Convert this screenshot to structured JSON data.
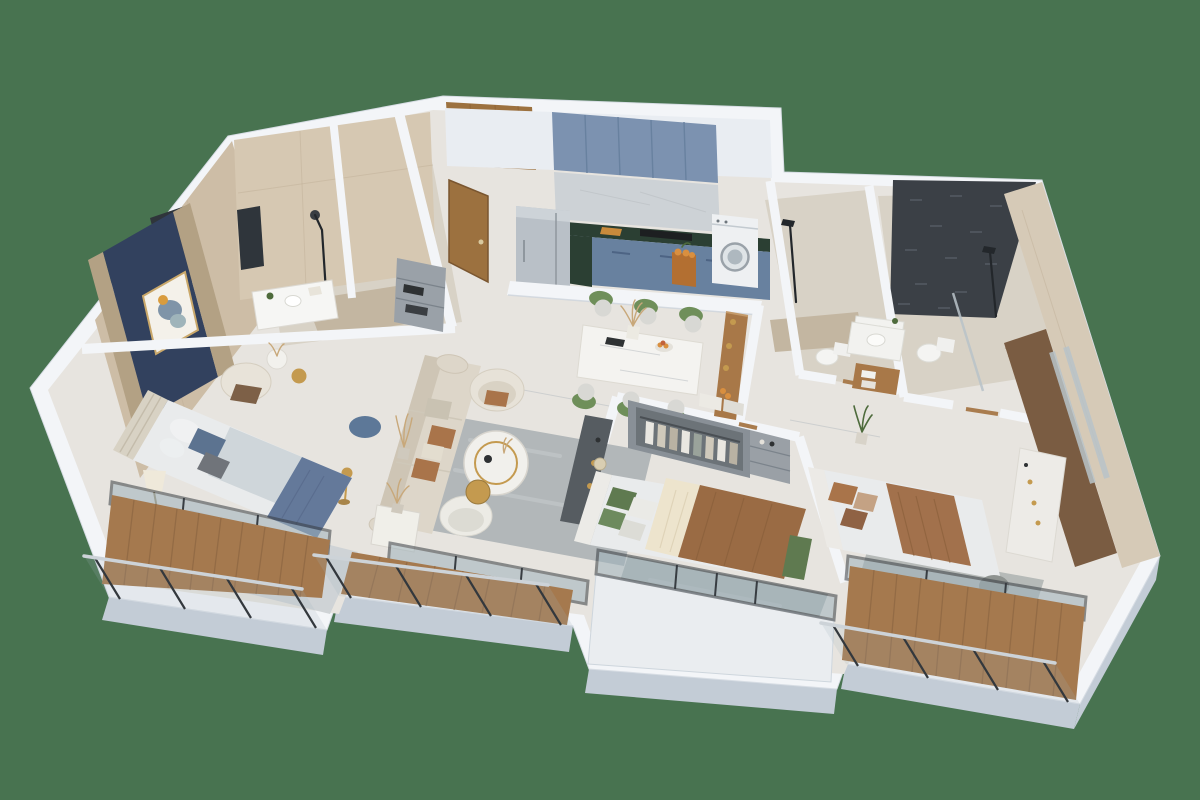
{
  "scene": {
    "type": "3d-floor-plan-render",
    "view": "isometric-cutaway",
    "subject": "apartment-with-three-bedrooms-two-bathrooms-kitchen-living-dining-and-balconies",
    "background_color": "#487350"
  },
  "palette": {
    "bg": "#487350",
    "wallTop": "#f3f5f8",
    "wallSide": "#c3ccd6",
    "wallFace": "#e9edf2",
    "floorMain": "#e7e4df",
    "floorBath": "#d8d2c6",
    "pebble": "#c3b6a1",
    "tileBeige": "#cdbda6",
    "tileBeigeLight": "#d6c8b2",
    "navy": "#32415e",
    "gold": "#b3a184",
    "art": "#f4f1ea",
    "radiator": "#2f353b",
    "woodDoor": "#9c713f",
    "woodFurn": "#a87848",
    "woodDeck": "#a5794e",
    "cabinetBlue": "#7c92b0",
    "cabinetBlueDark": "#68819f",
    "splash": "#cdd2d6",
    "counter": "#2b3f33",
    "steel": "#b9c0c7",
    "washer": "#eef0f2",
    "mosaic": "#3b4046",
    "eastTile": "#d6cab7",
    "sofa": "#ddd6c9",
    "sofaShade": "#cec5b5",
    "pillowBrown": "#a9744a",
    "rug": "#b2b7b9",
    "rugBlue": "#cfd3d6",
    "bedWhite": "#e9ebec",
    "duvetBlue": "#64799a",
    "pillowBlue": "#5c7390",
    "blanketBrown": "#9a6b44",
    "blanketRust": "#a2714c",
    "cream": "#ede4cd",
    "greenSoft": "#5f7a50",
    "chairGreen": "#6f8f5a",
    "chairSeat": "#d8d8d4",
    "glass": "#9fb2bb",
    "frame": "#383d42",
    "pouf": "#5d7898",
    "plant": "#4e6b3c",
    "shelf": "#9aa1a8",
    "console": "#565c61",
    "gild": "#c49a4f",
    "white": "#f6f6f4",
    "mirror": "#b9c4c9",
    "mirrorWood": "#7a5c42",
    "wardrobe": "#899097",
    "wardrobeIn": "#6c7378",
    "ledge": "#eaedf0",
    "orange": "#d98f3f"
  },
  "rooms": [
    {
      "name": "master-bathroom",
      "features": [
        "beige-marble-tile-walls",
        "walk-in-shower",
        "vanity-sink",
        "towel-radiator",
        "wall-mirror"
      ]
    },
    {
      "name": "entry-hall",
      "features": [
        "open-wood-door",
        "wood-wall-panel",
        "gray-shoe-shelf"
      ]
    },
    {
      "name": "kitchen",
      "features": [
        "blue-upper-cabinets",
        "blue-lower-cabinets",
        "marble-backsplash",
        "dark-stone-countertop",
        "cooktop",
        "stainless-refrigerator",
        "washing-machine",
        "orange-fruit-crate"
      ]
    },
    {
      "name": "dining-area",
      "features": [
        "white-marble-table",
        "six-green-chairs",
        "pampas-vase",
        "fruit-bowl",
        "black-tray",
        "wood-console-with-gold-decor"
      ]
    },
    {
      "name": "living-room",
      "features": [
        "beige-three-seat-sofa",
        "brown-accent-pillows",
        "round-armchair",
        "barrel-chair",
        "round-coffee-table-gold-base",
        "nesting-side-table",
        "gray-rug",
        "marble-side-table",
        "dried-plant",
        "gold-floor-lamp"
      ]
    },
    {
      "name": "master-bedroom",
      "features": [
        "navy-and-gold-headboard-wall",
        "framed-abstract-art",
        "double-bed-blue-bedding",
        "striped-headboard",
        "armchair",
        "round-side-tables",
        "table-lamp",
        "blue-pouf",
        "patterned-rug"
      ]
    },
    {
      "name": "bedroom-2",
      "features": [
        "open-wardrobe-with-clothes",
        "storage-shelf",
        "double-bed-brown-blanket",
        "cream-throw",
        "green-pillows",
        "green-bench",
        "dark-tv-console",
        "gray-rug",
        "bay-window"
      ]
    },
    {
      "name": "bathroom-2",
      "features": [
        "beige-tile-shower",
        "pebble-shower-floor",
        "toilet",
        "countertop-basin",
        "black-shower-fixture"
      ]
    },
    {
      "name": "ensuite-bathroom",
      "features": [
        "dark-mosaic-feature-wall",
        "walk-in-shower",
        "vanity-basin",
        "wood-towel-shelf",
        "toilet",
        "glass-screen"
      ]
    },
    {
      "name": "bedroom-3",
      "features": [
        "double-bed-rust-blanket",
        "brown-pillows",
        "open-wardrobe",
        "mirrored-wood-wardrobe-wall",
        "white-dresser-with-perfumes",
        "pouf",
        "gray-rug",
        "potted-plant"
      ]
    },
    {
      "name": "balcony-left",
      "features": [
        "wood-deck",
        "glass-railing-steel-handrail"
      ]
    },
    {
      "name": "balcony-center",
      "features": [
        "wood-deck",
        "glass-railing-steel-handrail"
      ]
    },
    {
      "name": "balcony-bay",
      "features": [
        "white-parapet-ledge",
        "sliding-glass-doors"
      ]
    },
    {
      "name": "balcony-right",
      "features": [
        "wood-deck",
        "glass-railing-steel-handrail"
      ]
    }
  ]
}
